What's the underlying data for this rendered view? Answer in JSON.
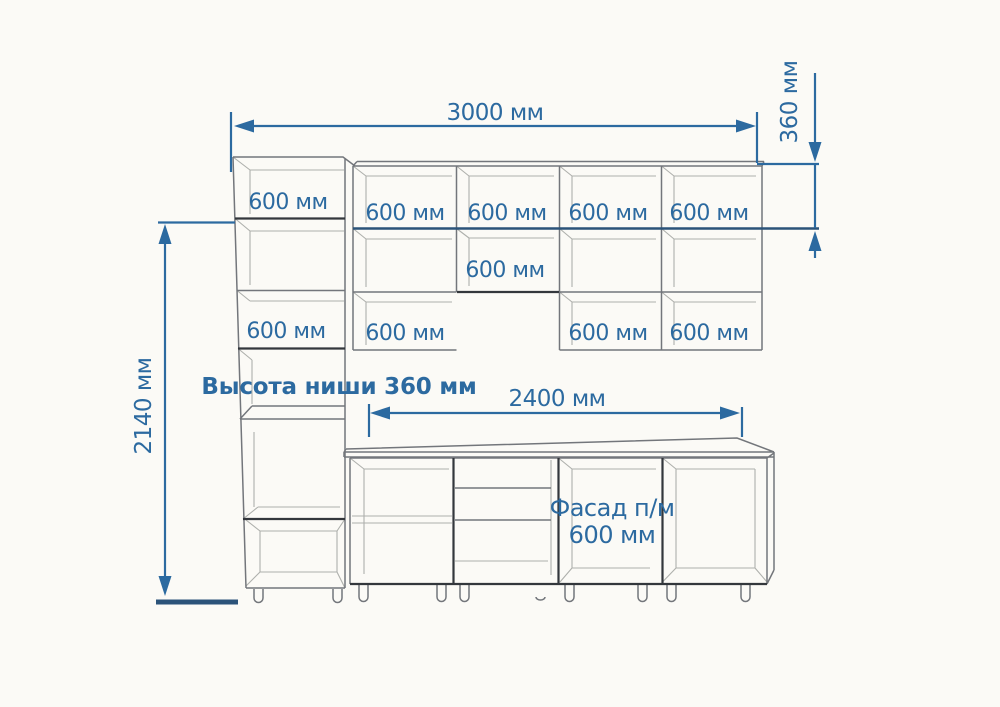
{
  "title": "Kitchen cabinet dimension drawing",
  "colors": {
    "bg": "#fbfaf6",
    "dim_blue": "#2c6aa0",
    "dim_dark": "#2b5379",
    "line_light": "#aeb0ac",
    "line_mid": "#73767b",
    "line_dark": "#33373c"
  },
  "dims": {
    "total_width": "3000 мм",
    "top_row_height": "360 мм",
    "column_height": "2140 мм",
    "base_width": "2400 мм"
  },
  "notes": {
    "niche": "Высота ниши 360 мм",
    "facade_line1": "Фасад п/м",
    "facade_line2": "600 мм"
  },
  "labels": {
    "tall_upper": "600 мм",
    "tall_lower": "600 мм",
    "wall_upper": [
      "600 мм",
      "600 мм",
      "600 мм",
      "600 мм"
    ],
    "hood_cabinet": "600 мм",
    "wall_lower": [
      "600 мм",
      "600 мм",
      "600 мм"
    ]
  }
}
